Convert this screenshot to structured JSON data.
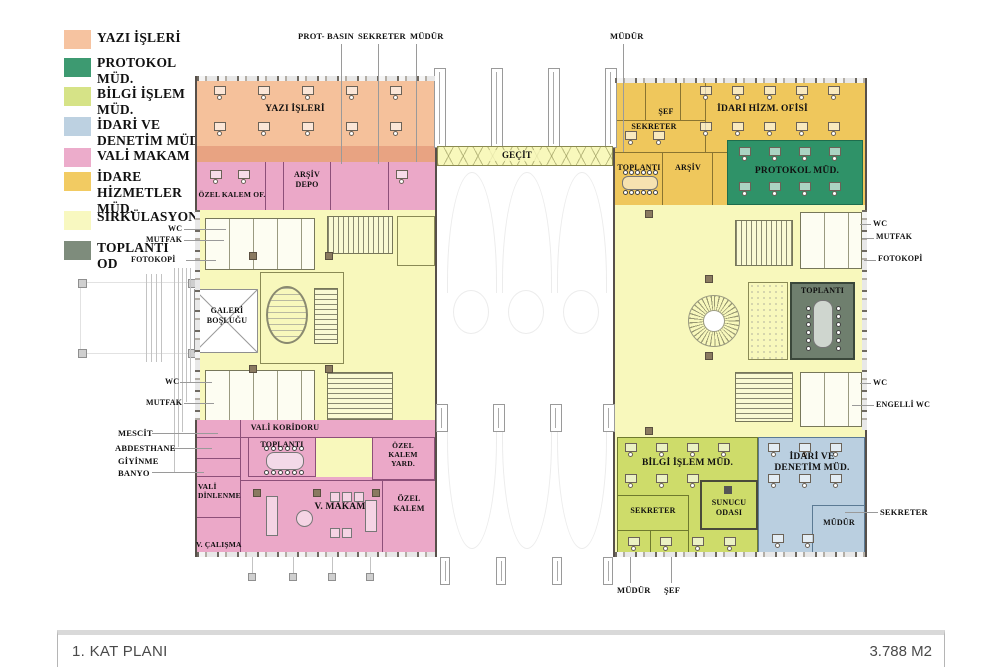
{
  "colors": {
    "yazi_isleri": "#F5C19B",
    "protokol": "#2F9268",
    "bilgi_islem": "#CEDC6A",
    "idari_denetim": "#BACFE0",
    "vali_makam": "#EBA8C8",
    "idare_hizmetler": "#EFC75C",
    "sirkulasyon": "#F8F8BC",
    "toplanti_od": "#6F7F6E"
  },
  "legend": {
    "items": [
      {
        "label": "YAZI İŞLERİ",
        "color": "#F6C3A0"
      },
      {
        "label": "PROTOKOL\nMÜD.",
        "color": "#3D9A71"
      },
      {
        "label": "BİLGİ İŞLEM\nMÜD.",
        "color": "#D6E387"
      },
      {
        "label": "İDARİ VE\nDENETİM MÜD.",
        "color": "#BDD1E1"
      },
      {
        "label": "VALİ MAKAM",
        "color": "#ECACCB"
      },
      {
        "label": "İDARE\nHİZMETLER\nMÜD.",
        "color": "#F2CB62"
      },
      {
        "label": "SİRKÜLASYON",
        "color": "#F8F8C0"
      },
      {
        "label": "TOPLANTI\nOD",
        "color": "#7E8C7C"
      }
    ]
  },
  "rooms": {
    "yazi_isleri": "YAZI İŞLERİ",
    "ozel_kalem_of": "ÖZEL KALEM OF.",
    "arsiv_depo": "ARŞİV\nDEPO",
    "galeri": "GALERİ\nBOŞLUĞU",
    "vali_koridoru": "VALİ KORİDORU",
    "toplanti_left": "TOPLANTI",
    "ozel_kalem_yard": "ÖZEL\nKALEM\nYARD.",
    "vali_dinlenme": "VALİ\nDİNLENME",
    "v_makam": "V. MAKAM",
    "ozel_kalem": "ÖZEL\nKALEM",
    "v_calisma": "V. ÇALIŞMA",
    "gecit": "GEÇİT",
    "sef": "ŞEF",
    "idari_hizm_ofisi": "İDARİ HİZM. OFİSİ",
    "sekreter_gold": "SEKRETER",
    "toplanti_gold": "TOPLANTI",
    "arsiv_gold": "ARŞİV",
    "protokol": "PROTOKOL MÜD.",
    "toplanti_dark": "TOPLANTI",
    "bilgi_islem": "BİLGİ İŞLEM MÜD.",
    "sekreter_lime": "SEKRETER",
    "sunucu": "SUNUCU\nODASI",
    "idari_denetim": "İDARİ VE\nDENETİM MÜD.",
    "mudur_blue": "MÜDÜR"
  },
  "callouts": {
    "prot_basin": "PROT- BASIN",
    "sekreter_top": "SEKRETER",
    "mudur_top": "MÜDÜR",
    "mudur_top_right": "MÜDÜR",
    "wc_mid": "WC",
    "mutfak_mid": "MUTFAK",
    "fotokopi_mid": "FOTOKOPİ",
    "wc_low": "WC",
    "mutfak_low": "MUTFAK",
    "mescit": "MESCİT",
    "abdesthane": "ABDESTHANE",
    "giyinme": "GİYİNME",
    "banyo": "BANYO",
    "wc_r1": "WC",
    "mutfak_r": "MUTFAK",
    "fotokopi_r": "FOTOKOPİ",
    "wc_r2": "WC",
    "engelli_wc": "ENGELLİ WC",
    "sekreter_r": "SEKRETER",
    "mudur_b": "MÜDÜR",
    "sef_b": "ŞEF"
  },
  "footer": {
    "title": "1. KAT PLANI",
    "area": "3.788 M2"
  }
}
